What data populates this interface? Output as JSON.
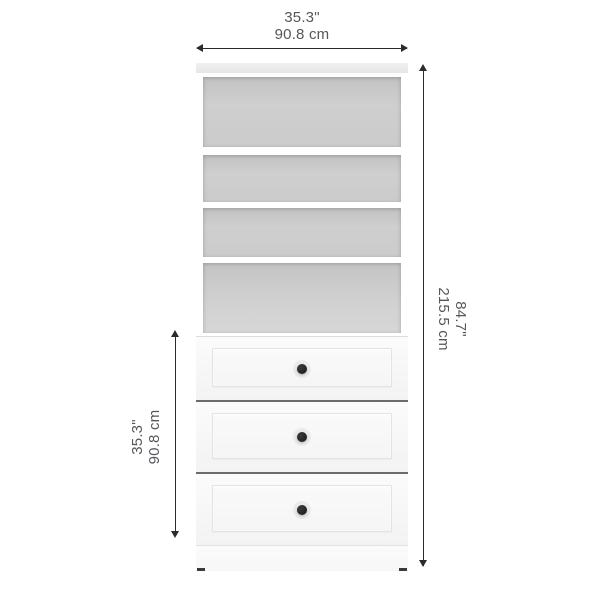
{
  "dimensions": {
    "width": {
      "inches": "35.3\"",
      "centimeters": "90.8 cm"
    },
    "height": {
      "inches": "84.7\"",
      "centimeters": "215.5 cm"
    },
    "drawer_section_height": {
      "inches": "35.3\"",
      "centimeters": "90.8 cm"
    }
  },
  "product": {
    "shelf_compartment_count": 4,
    "drawer_count": 3
  },
  "colors": {
    "background": "#ffffff",
    "dimension_text": "#54575b",
    "dimension_line": "#2b2b2b",
    "cabinet_interior": "#c9c9c9",
    "cabinet_top": "#e9e9e9",
    "drawer_face": "#f6f6f6",
    "drawer_separator": "#6b6b6b",
    "knob": "#222222"
  }
}
